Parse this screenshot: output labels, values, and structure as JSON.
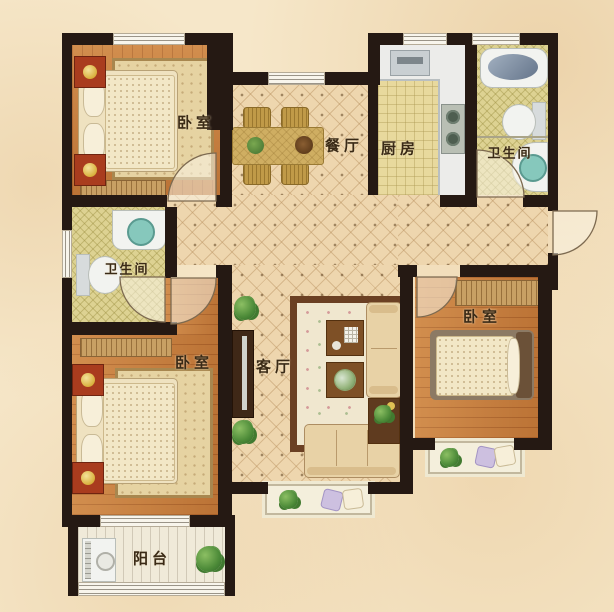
{
  "rooms": {
    "bedroom_top_left": {
      "label": "卧室"
    },
    "bedroom_bottom_left": {
      "label": "卧室"
    },
    "bedroom_right": {
      "label": "卧室"
    },
    "bathroom_left": {
      "label": "卫生间"
    },
    "bathroom_top_right": {
      "label": "卫生间"
    },
    "dining": {
      "label": "餐厅"
    },
    "kitchen": {
      "label": "厨房"
    },
    "living": {
      "label": "客厅"
    },
    "balcony": {
      "label": "阳台"
    }
  },
  "colors": {
    "background": "#f6e7c9",
    "wall": "#251913",
    "wood_floor": "#c87f3e",
    "tile_floor": "#eed6ae",
    "kitchen_floor": "#e8d99d",
    "bath_floor": "#ddd292",
    "balcony_floor": "#f0ead9",
    "label_text": "#3a2a16",
    "nightstand_red": "#a93c1e",
    "lamp_gold": "#e8c95e",
    "basin_teal": "#86c8bc"
  }
}
